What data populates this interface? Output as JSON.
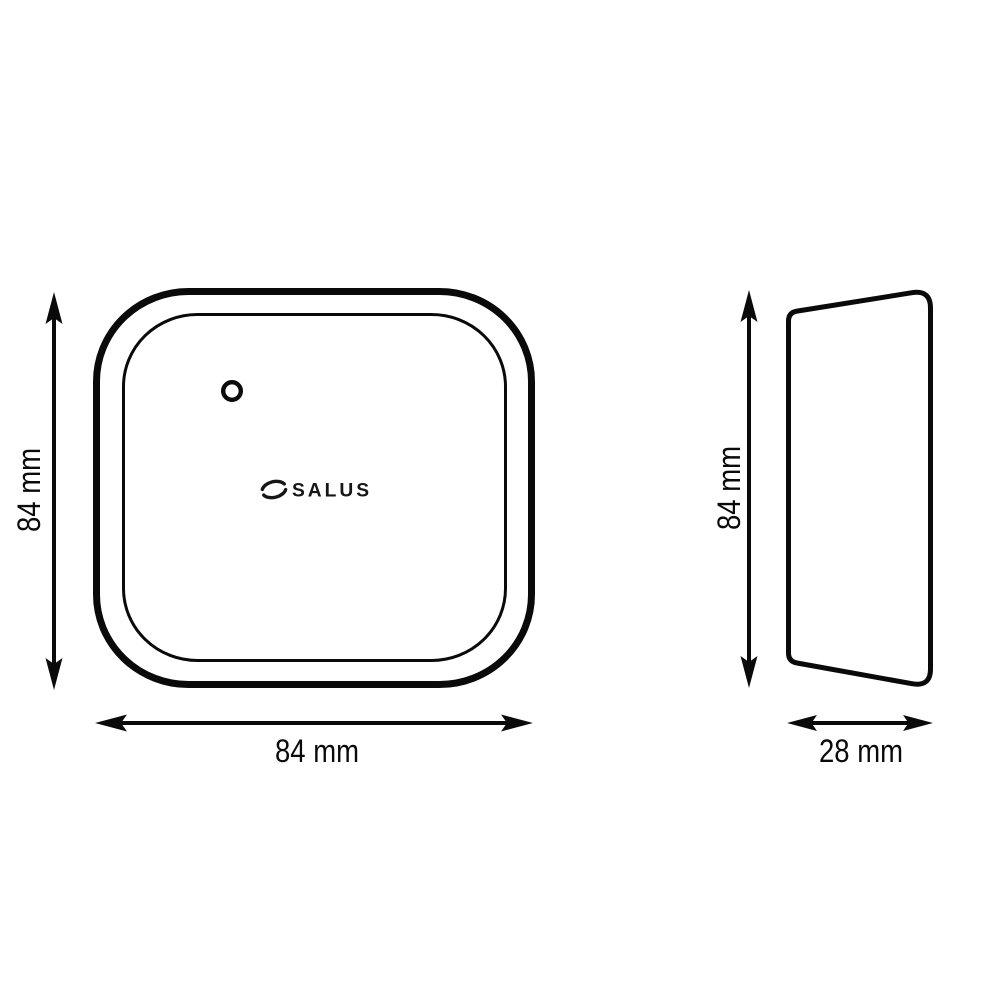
{
  "page": {
    "background_color": "#ffffff",
    "line_color": "#0a0a0a"
  },
  "product": {
    "brand": "SALUS"
  },
  "front_view": {
    "height_label": "84 mm",
    "width_label": "84 mm"
  },
  "side_view": {
    "height_label": "84 mm",
    "depth_label": "28 mm"
  }
}
